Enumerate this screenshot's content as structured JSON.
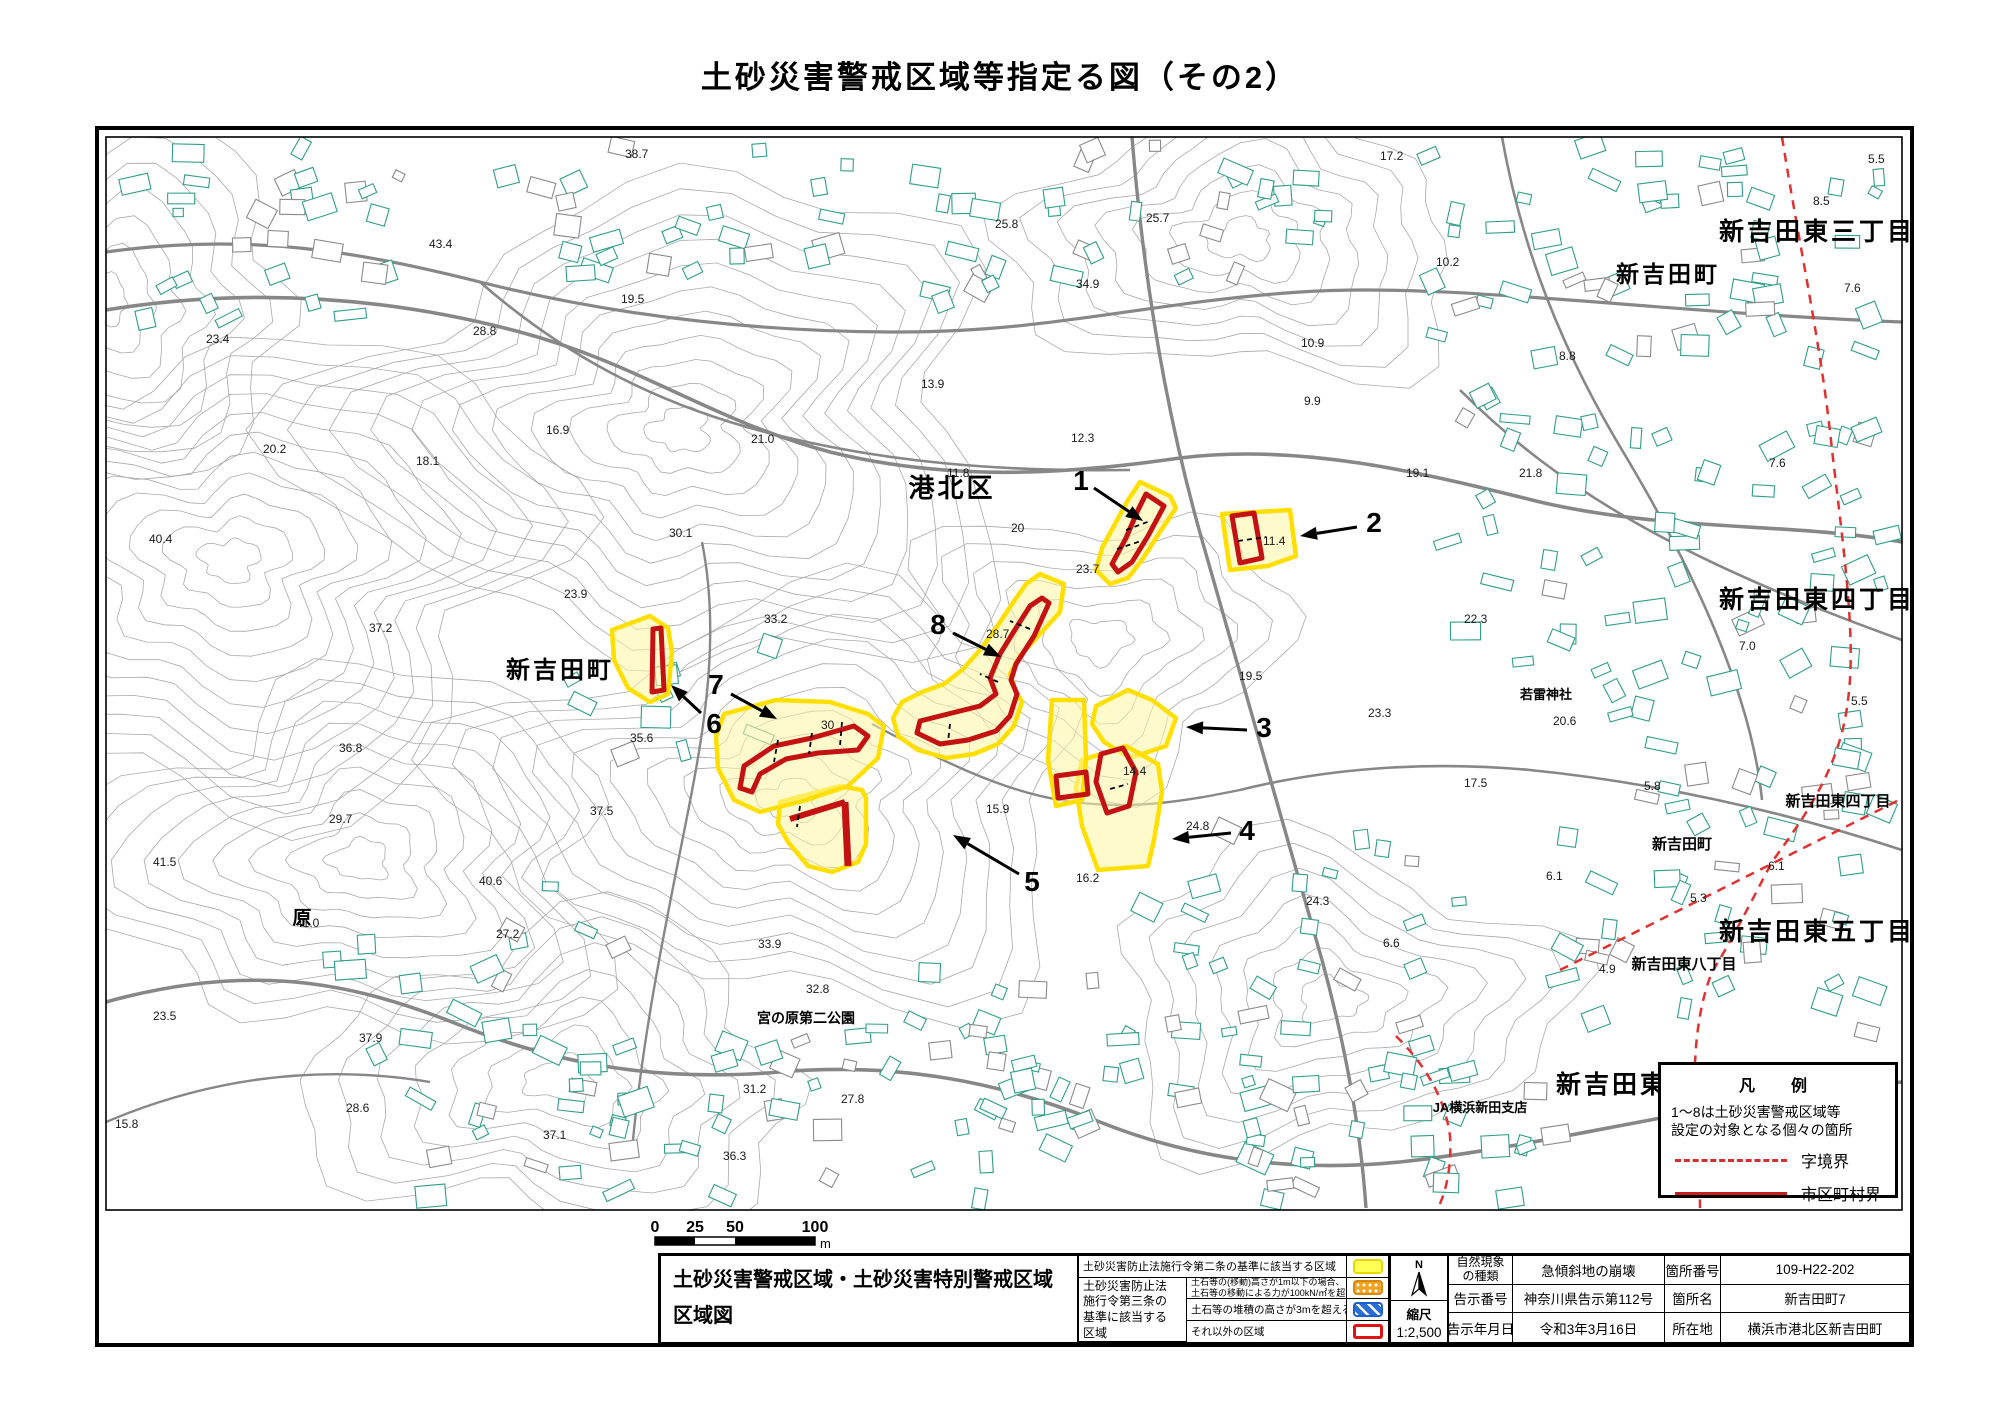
{
  "page_title": "土砂災害警戒区域等指定る図（その2）",
  "map": {
    "place_labels": [
      {
        "t": "港北区",
        "x": 952,
        "y": 497,
        "s": 26
      },
      {
        "t": "新吉田町",
        "x": 560,
        "y": 678,
        "s": 24
      },
      {
        "t": "新吉田東三丁目",
        "x": 1817,
        "y": 240,
        "s": 25
      },
      {
        "t": "新吉田町",
        "x": 1668,
        "y": 282,
        "s": 23
      },
      {
        "t": "新吉田東四丁目",
        "x": 1817,
        "y": 608,
        "s": 25
      },
      {
        "t": "新吉田東四丁目",
        "x": 1838,
        "y": 806,
        "s": 15
      },
      {
        "t": "新吉田町",
        "x": 1682,
        "y": 849,
        "s": 15
      },
      {
        "t": "新吉田東五丁目",
        "x": 1817,
        "y": 940,
        "s": 25
      },
      {
        "t": "新吉田東八丁目",
        "x": 1684,
        "y": 969,
        "s": 15
      },
      {
        "t": "新吉田東",
        "x": 1612,
        "y": 1093,
        "s": 25
      },
      {
        "t": "JA横浜新田支店",
        "x": 1480,
        "y": 1112,
        "s": 13
      },
      {
        "t": "若雷神社",
        "x": 1546,
        "y": 699,
        "s": 13
      },
      {
        "t": "宮の原第二公園",
        "x": 806,
        "y": 1023,
        "s": 14
      },
      {
        "t": "原",
        "x": 302,
        "y": 924,
        "s": 19
      }
    ],
    "spot_elevations": [
      {
        "v": "38.7",
        "x": 625,
        "y": 158
      },
      {
        "v": "17.2",
        "x": 1380,
        "y": 160
      },
      {
        "v": "5.5",
        "x": 1868,
        "y": 163
      },
      {
        "v": "25.8",
        "x": 995,
        "y": 228
      },
      {
        "v": "25.7",
        "x": 1146,
        "y": 222
      },
      {
        "v": "43.4",
        "x": 429,
        "y": 248
      },
      {
        "v": "34.9",
        "x": 1076,
        "y": 288
      },
      {
        "v": "19.5",
        "x": 621,
        "y": 303
      },
      {
        "v": "10.2",
        "x": 1436,
        "y": 266
      },
      {
        "v": "7.6",
        "x": 1844,
        "y": 292
      },
      {
        "v": "23.4",
        "x": 206,
        "y": 343
      },
      {
        "v": "28.8",
        "x": 473,
        "y": 335
      },
      {
        "v": "10.9",
        "x": 1301,
        "y": 347
      },
      {
        "v": "8.8",
        "x": 1559,
        "y": 360
      },
      {
        "v": "8.5",
        "x": 1813,
        "y": 205
      },
      {
        "v": "13.9",
        "x": 921,
        "y": 388
      },
      {
        "v": "16.9",
        "x": 546,
        "y": 434
      },
      {
        "v": "9.9",
        "x": 1304,
        "y": 405
      },
      {
        "v": "12.3",
        "x": 1071,
        "y": 442
      },
      {
        "v": "20.2",
        "x": 263,
        "y": 453
      },
      {
        "v": "18.1",
        "x": 416,
        "y": 465
      },
      {
        "v": "21.0",
        "x": 751,
        "y": 443
      },
      {
        "v": "11.8",
        "x": 947,
        "y": 477
      },
      {
        "v": "7.6",
        "x": 1769,
        "y": 467
      },
      {
        "v": "19.1",
        "x": 1406,
        "y": 477
      },
      {
        "v": "21.8",
        "x": 1519,
        "y": 477
      },
      {
        "v": "40.4",
        "x": 149,
        "y": 543
      },
      {
        "v": "30.1",
        "x": 669,
        "y": 537
      },
      {
        "v": "20",
        "x": 1011,
        "y": 532
      },
      {
        "v": "23.7",
        "x": 1076,
        "y": 573
      },
      {
        "v": "23.9",
        "x": 564,
        "y": 598
      },
      {
        "v": "22.3",
        "x": 1464,
        "y": 623
      },
      {
        "v": "33.2",
        "x": 764,
        "y": 623
      },
      {
        "v": "37.2",
        "x": 369,
        "y": 632
      },
      {
        "v": "28.7",
        "x": 986,
        "y": 638
      },
      {
        "v": "11.4",
        "x": 1263,
        "y": 545
      },
      {
        "v": "19.5",
        "x": 1239,
        "y": 680
      },
      {
        "v": "23.3",
        "x": 1368,
        "y": 717
      },
      {
        "v": "20.6",
        "x": 1553,
        "y": 725
      },
      {
        "v": "36.8",
        "x": 339,
        "y": 752
      },
      {
        "v": "35.6",
        "x": 630,
        "y": 742
      },
      {
        "v": "30",
        "x": 821,
        "y": 729
      },
      {
        "v": "14.4",
        "x": 1123,
        "y": 775
      },
      {
        "v": "7.0",
        "x": 1739,
        "y": 650
      },
      {
        "v": "5.5",
        "x": 1851,
        "y": 705
      },
      {
        "v": "37.5",
        "x": 590,
        "y": 815
      },
      {
        "v": "17.5",
        "x": 1464,
        "y": 787
      },
      {
        "v": "5.8",
        "x": 1644,
        "y": 790
      },
      {
        "v": "29.7",
        "x": 329,
        "y": 823
      },
      {
        "v": "15.9",
        "x": 986,
        "y": 813
      },
      {
        "v": "24.8",
        "x": 1186,
        "y": 830
      },
      {
        "v": "41.5",
        "x": 153,
        "y": 866
      },
      {
        "v": "40.6",
        "x": 479,
        "y": 885
      },
      {
        "v": "16.2",
        "x": 1076,
        "y": 882
      },
      {
        "v": "6.1",
        "x": 1546,
        "y": 880
      },
      {
        "v": "6.1",
        "x": 1768,
        "y": 870
      },
      {
        "v": "41.0",
        "x": 296,
        "y": 927
      },
      {
        "v": "24.3",
        "x": 1306,
        "y": 905
      },
      {
        "v": "27.2",
        "x": 496,
        "y": 938
      },
      {
        "v": "33.9",
        "x": 758,
        "y": 948
      },
      {
        "v": "6.6",
        "x": 1383,
        "y": 947
      },
      {
        "v": "5.3",
        "x": 1690,
        "y": 902
      },
      {
        "v": "4.9",
        "x": 1599,
        "y": 973
      },
      {
        "v": "23.5",
        "x": 153,
        "y": 1020
      },
      {
        "v": "32.8",
        "x": 806,
        "y": 993
      },
      {
        "v": "37.9",
        "x": 359,
        "y": 1042
      },
      {
        "v": "28.6",
        "x": 346,
        "y": 1112
      },
      {
        "v": "15.8",
        "x": 115,
        "y": 1128
      },
      {
        "v": "37.1",
        "x": 543,
        "y": 1139
      },
      {
        "v": "36.3",
        "x": 723,
        "y": 1160
      },
      {
        "v": "31.2",
        "x": 743,
        "y": 1093
      },
      {
        "v": "27.8",
        "x": 841,
        "y": 1103
      }
    ],
    "zones": [
      {
        "n": "1",
        "lx": 1081,
        "ly": 490,
        "ax1": 1094,
        "ay1": 488,
        "ax2": 1143,
        "ay2": 521
      },
      {
        "n": "2",
        "lx": 1374,
        "ly": 532,
        "ax1": 1357,
        "ay1": 527,
        "ax2": 1300,
        "ay2": 536
      },
      {
        "n": "3",
        "lx": 1264,
        "ly": 737,
        "ax1": 1247,
        "ay1": 730,
        "ax2": 1186,
        "ay2": 727
      },
      {
        "n": "4",
        "lx": 1247,
        "ly": 840,
        "ax1": 1231,
        "ay1": 833,
        "ax2": 1172,
        "ay2": 839
      },
      {
        "n": "5",
        "lx": 1032,
        "ly": 891,
        "ax1": 1019,
        "ay1": 874,
        "ax2": 953,
        "ay2": 835
      },
      {
        "n": "6",
        "lx": 714,
        "ly": 733,
        "ax1": 701,
        "ay1": 713,
        "ax2": 671,
        "ay2": 685
      },
      {
        "n": "7",
        "lx": 716,
        "ly": 694,
        "ax1": 731,
        "ay1": 694,
        "ax2": 777,
        "ay2": 719
      },
      {
        "n": "8",
        "lx": 938,
        "ly": 634,
        "ax1": 953,
        "ay1": 633,
        "ax2": 1001,
        "ay2": 657
      }
    ]
  },
  "legend_box": {
    "title": "凡　例",
    "line1": "1～8は土砂災害警戒区域等",
    "line2": "設定の対象となる個々の箇所",
    "dashed_label": "字境界",
    "solid_label": "市区町村界"
  },
  "scale_bar": {
    "ticks": [
      "0",
      "25",
      "50",
      "100"
    ],
    "unit": "m"
  },
  "bottom": {
    "sheet_title_line1": "土砂災害警戒区域・土砂災害特別警戒区域",
    "sheet_title_line2": "区域図",
    "legend_table": {
      "row1_label": "土砂災害防止法施行令第二条の基準に該当する区域",
      "group_label": "土砂災害防止法 施行令第三条の 基準に該当する 区域",
      "row2_line1": "土石等の(移動)高さが1m以下の場合、",
      "row2_line2": "土石等の移動による力が100kN/㎡を超える区域",
      "row3_label": "土石等の堆積の高さが3mを超える区域",
      "row4_label": "それ以外の区域"
    },
    "north_label": "N",
    "scale_label": "縮尺",
    "scale_value": "1:2,500",
    "info_table": {
      "r1": {
        "l1a": "自然現象",
        "l1b": "の種類",
        "v1": "急傾斜地の崩壊",
        "l2": "箇所番号",
        "v2": "109-H22-202"
      },
      "r2": {
        "l1": "告示番号",
        "v1": "神奈川県告示第112号",
        "l2": "箇所名",
        "v2": "新吉田町7"
      },
      "r3": {
        "l1": "告示年月日",
        "v1": "令和3年3月16日",
        "l2": "所在地",
        "v2": "横浜市港北区新吉田町"
      }
    }
  }
}
